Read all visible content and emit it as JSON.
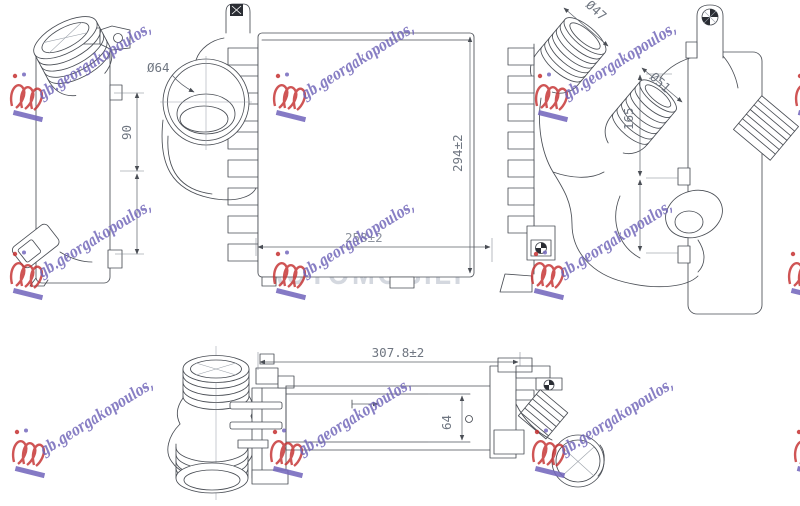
{
  "product_drawing": {
    "description": "technical drawing of an intercooler radiator shown in four projection views",
    "dimensions": {
      "front_height": "90",
      "main_port_diameter": "Ø64",
      "main_height": "294±2",
      "main_width": "258±2",
      "side_hose_top_diameter": "Ø47",
      "side_hose_mid_diameter": "Ø51",
      "side_height": "165",
      "bottom_length": "307.8±2",
      "bottom_depth": "64"
    },
    "watermark": {
      "script": "gb.georgakopoulos,",
      "gray_line1": "POLOVNI",
      "gray_line2": "AUTOMOBILI"
    },
    "colors": {
      "line": "#4a4e55",
      "dimension_text": "#6f7681",
      "watermark_script": "#6e63b8",
      "watermark_logo_red": "#c53030",
      "watermark_underline": "#7468bd",
      "watermark_gray": "#d2d6de",
      "background": "#ffffff"
    }
  }
}
